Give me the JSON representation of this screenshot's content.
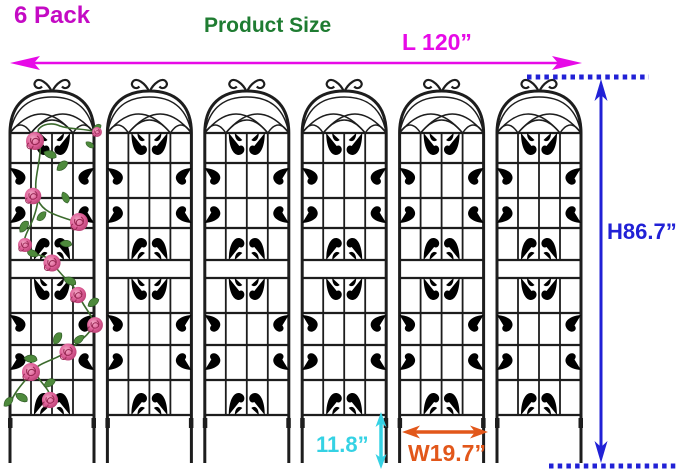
{
  "badge": {
    "text": "6 Pack"
  },
  "heading": {
    "text": "Product Size"
  },
  "dimensions": {
    "length": {
      "label": "L 120”"
    },
    "height": {
      "label": "H86.7”"
    },
    "panel_width": {
      "label": "W19.7”"
    },
    "leg_height": {
      "label": "11.8”"
    }
  },
  "product": {
    "name": "Metal garden trellis panels",
    "panel_count": 6,
    "decoration": "Pink climbing roses on left panel"
  },
  "colors": {
    "badge-magenta": "#c40ac4",
    "heading-green": "#1f7c32",
    "length-magenta": "#e70ae7",
    "height-blue": "#2121d6",
    "leg-cyan": "#35d2e4",
    "width-orange": "#e2571a",
    "iron": "#1d1d1d",
    "rose-pink": "#dd5f97",
    "leaf-green": "#4e8a3c",
    "background": "#ffffff"
  }
}
